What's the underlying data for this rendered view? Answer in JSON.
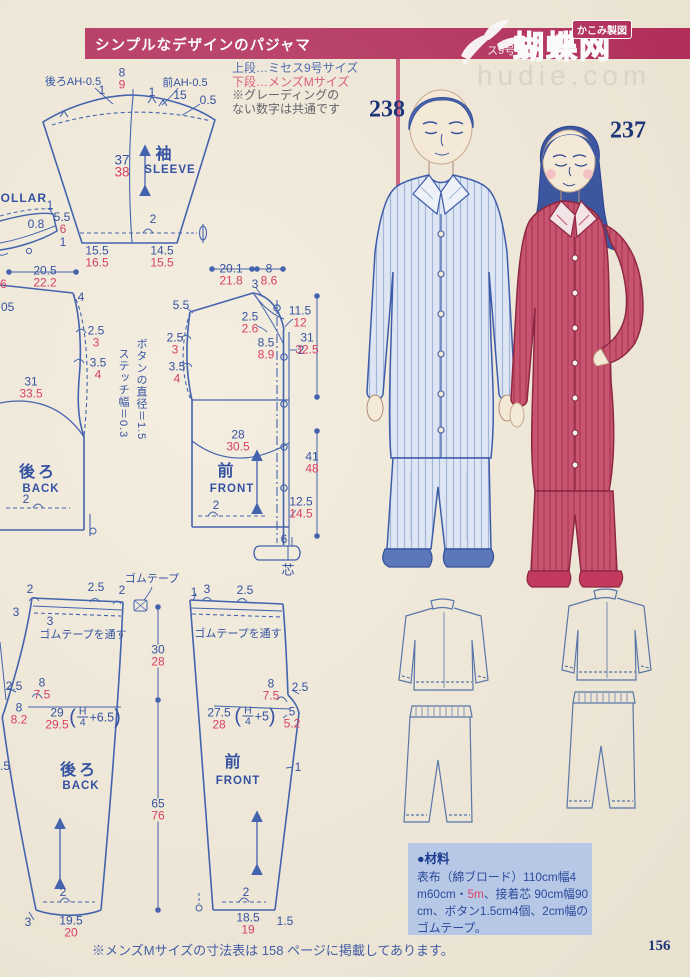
{
  "colors": {
    "banner_crimson": "#b12553",
    "measure_blue": "#3552a2",
    "measure_red": "#d84064",
    "number_navy": "#1e3577",
    "materials_box_blue": "#b6c8e6",
    "watermark_gray": "#d6d3c8"
  },
  "banner": {
    "title": "シンプルなデザインのパジャマ",
    "badge": "かこみ製図",
    "logo": "蝴蝶网",
    "logo_prefix": "ス9号",
    "watermark": "hudie.com"
  },
  "size_info": {
    "line1": "上段…ミセス9号サイズ",
    "line2": "下段…メンズMサイズ",
    "line3": "※グレーディングの",
    "line4": "ない数字は共通です"
  },
  "figures": {
    "man_number": "238",
    "woman_number": "237"
  },
  "patterns": {
    "sleeve": {
      "back_ah": "後ろAH-0.5",
      "front_ah": "前AH-0.5",
      "one_l": "1",
      "cap_b": "8",
      "cap_r": "9",
      "one_r": "1",
      "n15": "15",
      "n05": "0.5",
      "len_b": "37",
      "len_r": "38",
      "title_jp": "袖",
      "title_en": "SLEEVE",
      "hem_two": "2",
      "hem_l_b": "15.5",
      "hem_l_r": "16.5",
      "hem_r_b": "14.5",
      "hem_r_r": "15.5"
    },
    "collar": {
      "title": "COLLAR",
      "one_top": "1",
      "n55": "5.5",
      "n6": "6",
      "n08": "0.8",
      "one_bot": "1"
    },
    "back": {
      "w_b": "20.5",
      "w_r": "22.2",
      "n4": "4",
      "a1_b": "2.5",
      "a1_r": "3",
      "a2_b": "3.5",
      "a2_r": "4",
      "len_b": "31",
      "len_r": "33.5",
      "title_jp": "後ろ",
      "title_en": "BACK",
      "hem_two": "2",
      "note_button": "ボタンの直径＝1.5",
      "note_stitch": "ステッチ幅＝0.3"
    },
    "front": {
      "w1_b": "20.1",
      "w1_r": "21.8",
      "w2_b": "8",
      "w2_r": "8.6",
      "n3": "3",
      "n55": "5.5",
      "nk_b": "2.5",
      "nk_r": "2.6",
      "r1_b": "11.5",
      "r1_r": "12",
      "a1_b": "2.5",
      "a1_r": "3",
      "a2_b": "3.5",
      "a2_r": "4",
      "c_b": "8.5",
      "c_r": "8.9",
      "n2": "2",
      "len1_b": "31",
      "len1_r": "32.5",
      "curve_b": "28",
      "curve_r": "30.5",
      "title_jp": "前",
      "title_en": "FRONT",
      "len2_b": "41",
      "len2_r": "48",
      "hem_b": "12.5",
      "hem_r": "14.5",
      "hem_two": "2",
      "n6": "6",
      "interfacing": "芯"
    },
    "pants_back": {
      "t1": "2",
      "t2": "2.5",
      "t3": "2",
      "t4": "3",
      "t5": "3",
      "elastic": "ゴムテープ",
      "thread": "ゴムテープを通す",
      "rise_b": "30",
      "rise_r": "28",
      "c1": "2.5",
      "c2_b": "8",
      "c2_r": "7.5",
      "c3_b": "8",
      "c3_r": "8.2",
      "hip_b": "29",
      "hip_r": "29.5",
      "f_open": "(",
      "f_num": "H",
      "f_den": "4",
      "f_plus": "+6.5",
      "f_close": ")",
      "title_jp": "後ろ",
      "title_en": "BACK",
      "len_b": "65",
      "len_r": "76",
      "hem_two": "2",
      "hem3": "3",
      "hem_b": "19.5",
      "hem_r": "20"
    },
    "pants_front": {
      "t1": "1",
      "t2": "3",
      "t3": "2.5",
      "thread": "ゴムテープを通す",
      "c1_b": "8",
      "c1_r": "7.5",
      "c2": "2.5",
      "c3_b": "5",
      "c3_r": "5.2",
      "hip_b": "27.5",
      "hip_r": "28",
      "f_open": "(",
      "f_num": "H",
      "f_den": "4",
      "f_plus": "+5",
      "f_close": ")",
      "n1": "1",
      "title_jp": "前",
      "title_en": "FRONT",
      "hem_two": "2",
      "hem_b": "18.5",
      "hem_r": "19",
      "hem15": "1.5"
    },
    "edge": {
      "e6": "6",
      "e05": "05",
      "e5": ".5"
    }
  },
  "materials": {
    "header": "●材料",
    "line1": "表布（綿ブロード）110cm幅4",
    "line2a": "m60cm・",
    "line2b": "5m",
    "line2c": "、接着芯 90cm幅90",
    "line3": "cm、ボタン1.5cm4個、2cm幅の",
    "line4": "ゴムテープ。"
  },
  "footer": {
    "note": "※メンズMサイズの寸法表は 158 ページに掲載してあります。",
    "page": "156"
  }
}
